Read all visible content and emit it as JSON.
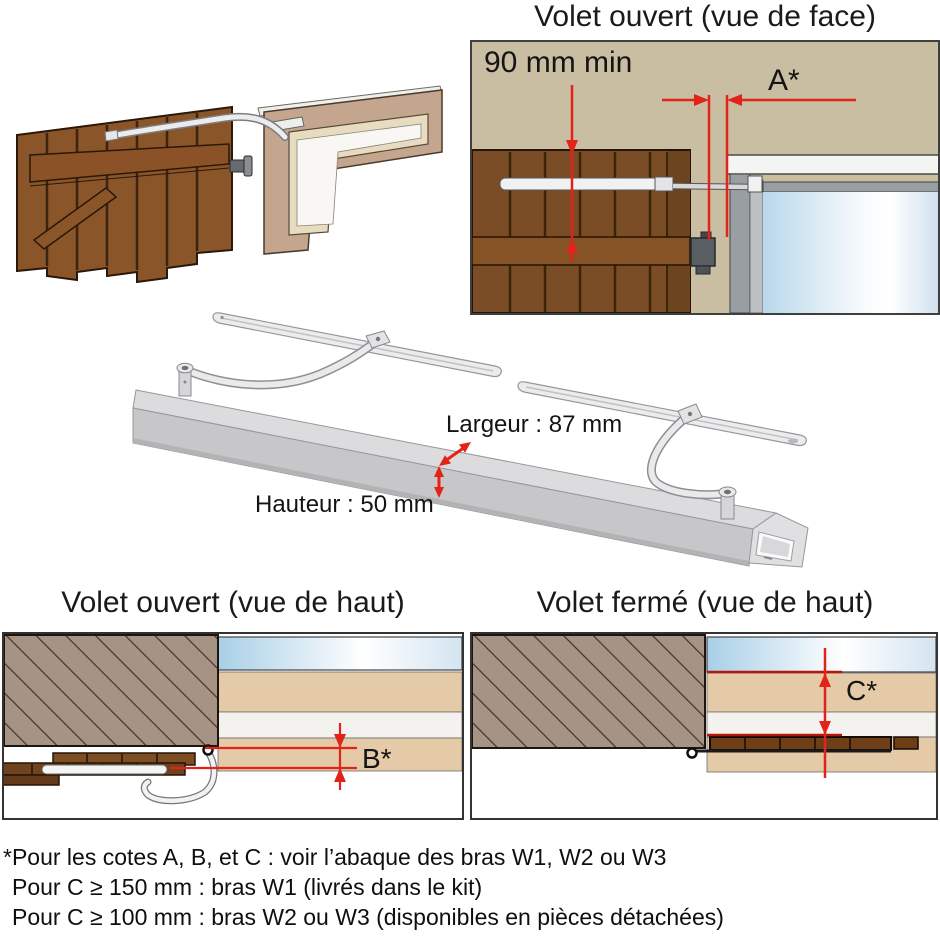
{
  "front_view": {
    "title": "Volet ouvert (vue de face)",
    "dim_height_min": "90 mm min",
    "dim_a": "A*"
  },
  "actuator_bar": {
    "width_label": "Largeur : 87 mm",
    "height_label": "Hauteur : 50 mm"
  },
  "top_view_open": {
    "title": "Volet ouvert (vue de haut)",
    "dim_b": "B*"
  },
  "top_view_closed": {
    "title": "Volet fermé (vue de haut)",
    "dim_c": "C*"
  },
  "footnotes": {
    "line1": "*Pour les cotes A, B, et C : voir l’abaque des bras W1, W2 ou W3",
    "line2": "Pour C ≥ 150 mm : bras W1 (livrés dans le kit)",
    "line3": "Pour C ≥ 100 mm : bras W2 ou W3 (disponibles en pièces détachées)"
  },
  "colors": {
    "dimension_red": "#e2231a",
    "wall_tan": "#c9bda2",
    "shutter_brown": "#7a4d26",
    "glass_blue": "#b9d8eb",
    "hatched_wall": "#a79384"
  }
}
